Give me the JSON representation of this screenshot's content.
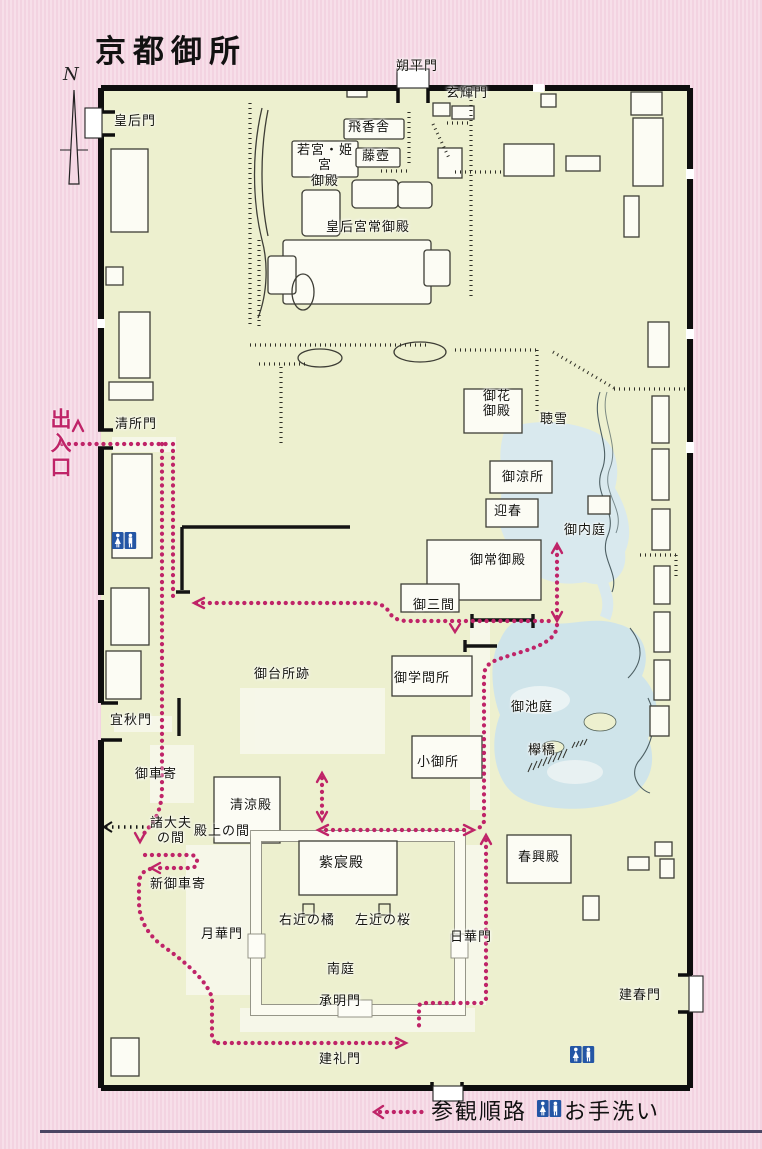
{
  "title": "京都御所",
  "compass": {
    "north_label": "N"
  },
  "entrance_label": "出入口",
  "legend": {
    "route_label": "参観順路",
    "restroom_label": "お手洗い"
  },
  "colors": {
    "background_pink": "#f5d8e4",
    "map_fill": "#edf0cf",
    "wall_black": "#141414",
    "building_white": "#fcfcf4",
    "pond_blue": "#cfe4ea",
    "route_magenta": "#bf2468",
    "restroom_blue": "#2456a5",
    "bottom_rule_navy": "#4a4663"
  },
  "icons": [
    "north-arrow-icon",
    "restroom-icon",
    "route-dotted-icon"
  ],
  "labels": [
    {
      "id": "kogomon",
      "text": "皇后門"
    },
    {
      "id": "sakuheimon",
      "text": "朔平門"
    },
    {
      "id": "genkimon",
      "text": "玄輝門"
    },
    {
      "id": "higyosha",
      "text": "飛香舎"
    },
    {
      "id": "fujitsubo",
      "text": "藤壺"
    },
    {
      "id": "wakamiya-himemiya-goten",
      "text": "若宮・姫宮\n御殿"
    },
    {
      "id": "kogogu-tsunegoten",
      "text": "皇后宮常御殿"
    },
    {
      "id": "ohana-goten",
      "text": "御花\n御殿"
    },
    {
      "id": "chosetsu",
      "text": "聴雪"
    },
    {
      "id": "oryosho",
      "text": "御涼所"
    },
    {
      "id": "geishun",
      "text": "迎春"
    },
    {
      "id": "onaitei",
      "text": "御内庭"
    },
    {
      "id": "otsune-goten",
      "text": "御常御殿"
    },
    {
      "id": "omima",
      "text": "御三間"
    },
    {
      "id": "seishomon",
      "text": "清所門"
    },
    {
      "id": "odaidokoro-ato",
      "text": "御台所跡"
    },
    {
      "id": "ogakumonjo",
      "text": "御学問所"
    },
    {
      "id": "kogosho",
      "text": "小御所"
    },
    {
      "id": "oikeniwa",
      "text": "御池庭"
    },
    {
      "id": "keyakibashi",
      "text": "欅橋"
    },
    {
      "id": "gishumon",
      "text": "宜秋門"
    },
    {
      "id": "okurumayose",
      "text": "御車寄"
    },
    {
      "id": "shodaibu-no-ma",
      "text": "諸大夫\nの間"
    },
    {
      "id": "shin-okurumayose",
      "text": "新御車寄"
    },
    {
      "id": "seiryoden",
      "text": "清涼殿"
    },
    {
      "id": "tenjo-no-ma",
      "text": "殿上の間"
    },
    {
      "id": "shishinden",
      "text": "紫宸殿"
    },
    {
      "id": "ukon-no-tachibana",
      "text": "右近の橘"
    },
    {
      "id": "sakon-no-sakura",
      "text": "左近の桜"
    },
    {
      "id": "gekkamon",
      "text": "月華門"
    },
    {
      "id": "nikkamon",
      "text": "日華門"
    },
    {
      "id": "nantei",
      "text": "南庭"
    },
    {
      "id": "jomeimon",
      "text": "承明門"
    },
    {
      "id": "kenreimon",
      "text": "建礼門"
    },
    {
      "id": "shunkoden",
      "text": "春興殿"
    },
    {
      "id": "kenshunmon",
      "text": "建春門"
    }
  ]
}
